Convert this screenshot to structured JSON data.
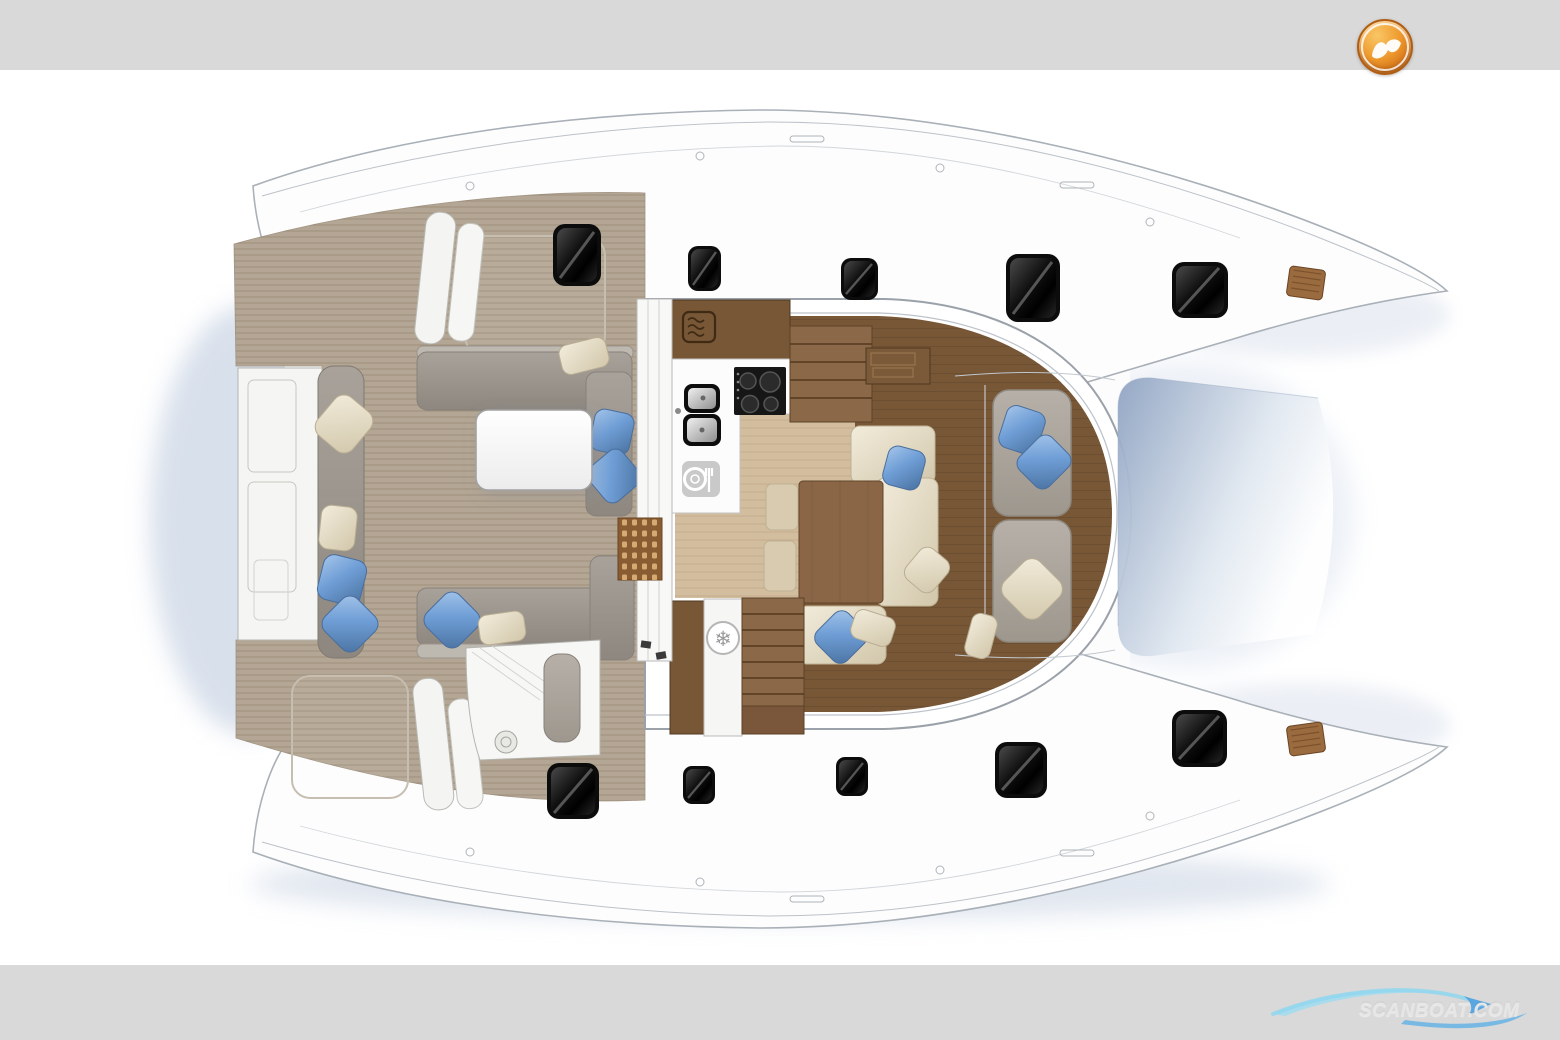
{
  "page": {
    "bands": {
      "top_height_px": 70,
      "bottom_height_px": 75
    }
  },
  "theme": {
    "page_bg": "#ffffff",
    "band": "#d9d9d9",
    "hull_fill": "#fdfdfd",
    "hull_line": "#a9b0b8",
    "teak": "#b4a694",
    "wood_dark": "#785737",
    "wood_mid": "#8a6848",
    "wood_light": "#d3bd9f",
    "sofa_gray": "#9b958d",
    "pad_gray": "#aaa49c",
    "cream": "#e6ddc8",
    "pillow_blue": "#6f9ed6",
    "hatch_black": "#0c0c0c",
    "shadow_blue": "#b9c7dc",
    "logo_orange": "#e8861f",
    "watermark_blue": "#56aade",
    "watermark_text": "#e6e6e6"
  },
  "branding": {
    "logo_icon": "scanboat-logo-icon",
    "watermark_text": "SCANBOAT.COM"
  },
  "floorplan": {
    "kind": "catamaran deck and saloon layout, top view",
    "areas": [
      "aft-swim-platform",
      "transom-bench",
      "cockpit",
      "cockpit-lounge",
      "helm-station",
      "saloon",
      "galley",
      "dinette",
      "navigation-table",
      "foredeck-sunpads",
      "trampoline",
      "port-hull-deck",
      "starboard-hull-deck"
    ],
    "equipment_icons": [
      "microwave-icon",
      "cooktop-icon",
      "double-sink-icon",
      "dining-icon",
      "fridge-snowflake-icon"
    ],
    "counts": {
      "deck_hatches": 10,
      "hull_vents": 2,
      "sunpads": 2,
      "sofas": 4,
      "tables": 2,
      "staircases": 2,
      "pillows_blue": 9,
      "pillows_cream": 8
    }
  }
}
